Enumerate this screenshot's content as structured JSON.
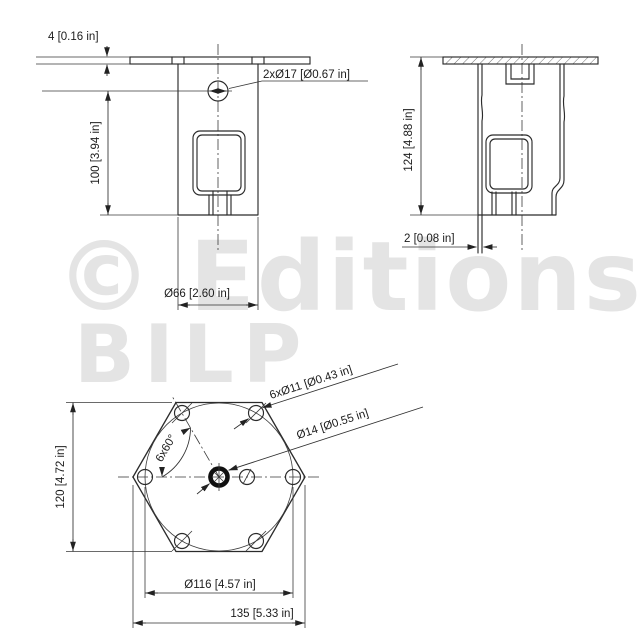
{
  "drawing": {
    "watermark": {
      "line1": "© Editions",
      "line2": "BILP",
      "color": "#e4e4e4"
    },
    "line_color": "#2b2b2b",
    "front_view": {
      "flange_thickness_label": "4 [0.16 in]",
      "height_label": "100 [3.94 in]",
      "top_holes_label": "2xØ17 [Ø0.67 in]",
      "body_width_label": "Ø66 [2.60 in]"
    },
    "side_view": {
      "height_label": "124 [4.88 in]",
      "wall_thickness_label": "2 [0.08 in]"
    },
    "bottom_view": {
      "corner_holes_label": "6xØ11 [Ø0.43 in]",
      "center_hole_label": "Ø14 [Ø0.55 in]",
      "angle_label": "6x60°",
      "across_flats_label": "120 [4.72 in]",
      "bolt_circle_label": "Ø116 [4.57 in]",
      "across_corners_label": "135 [5.33 in]"
    }
  }
}
